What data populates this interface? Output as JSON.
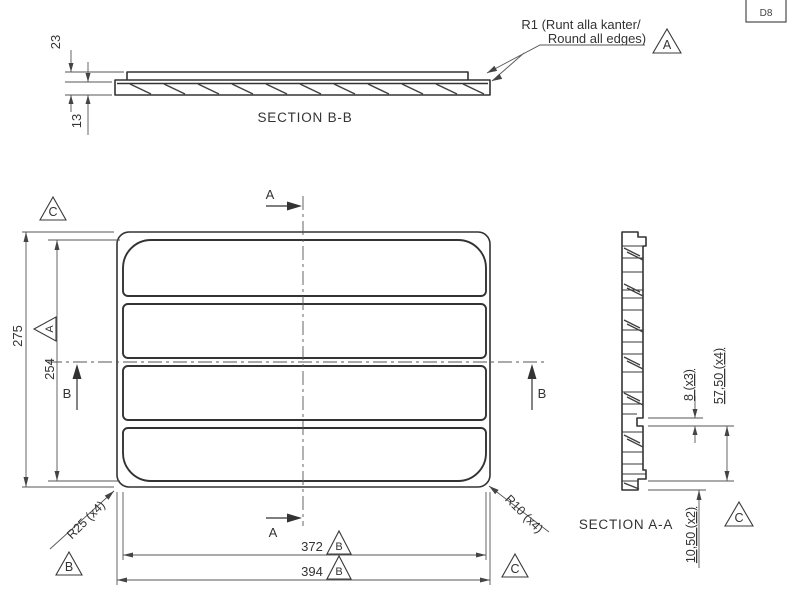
{
  "drawing": {
    "title_block_code": "D8",
    "note": {
      "line1": "R1 (Runt alla kanter/",
      "line2": "Round all edges)",
      "datum": "A"
    },
    "section_bb": {
      "label": "SECTION B-B",
      "dim_total_thickness": "23",
      "dim_base_thickness": "13"
    },
    "plan": {
      "dim_outer_height": "275",
      "dim_inner_height": "254",
      "dim_inner_width": "372",
      "dim_outer_width": "394",
      "radius_corner_inner": "R25 (x4)",
      "radius_corner_outer": "R10 (x4)",
      "cut_a": "A",
      "cut_b": "B",
      "datum_top_left": "C",
      "datum_inner_height": "A",
      "datum_bottom_left": "B",
      "datum_inner_width": "B",
      "datum_outer_width": "B",
      "datum_bottom_right": "C"
    },
    "section_aa": {
      "label": "SECTION A-A",
      "dim_slot_depth": "8 (x3)",
      "dim_pitch": "57,50 (x4)",
      "dim_edge": "10,50 (x2)",
      "datum": "C"
    },
    "colors": {
      "line": "#333333",
      "background": "#ffffff"
    }
  }
}
